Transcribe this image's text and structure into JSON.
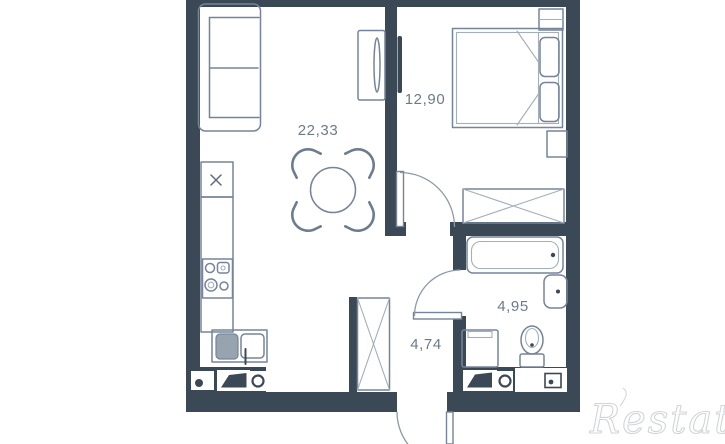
{
  "floor_plan": {
    "type": "apartment-floor-plan",
    "rooms": [
      {
        "id": "living-room-kitchen",
        "area": "22,33"
      },
      {
        "id": "bedroom",
        "area": "12,90"
      },
      {
        "id": "bathroom",
        "area": "4,95"
      },
      {
        "id": "hallway",
        "area": "4,74"
      }
    ],
    "furniture": [
      "sofa",
      "tv-unit",
      "tv-bedroom",
      "dining-table",
      "chairs",
      "kitchen-sink",
      "kitchen-counter",
      "stove",
      "kitchen-cabinet",
      "bed",
      "pillows",
      "nightstands",
      "wardrobe",
      "hallway-closet",
      "bathtub",
      "washbasin",
      "washing-machine",
      "toilet"
    ],
    "colors": {
      "wall": "#3b4855",
      "furniture_line": "#75849a",
      "furniture_line_light": "#a3afbb",
      "appliance_fill": "#97a3ae",
      "label_text": "#6b7b8e",
      "background": "#ffffff"
    }
  },
  "watermark": {
    "text": "Restate",
    "color": "#d2d5d8"
  }
}
